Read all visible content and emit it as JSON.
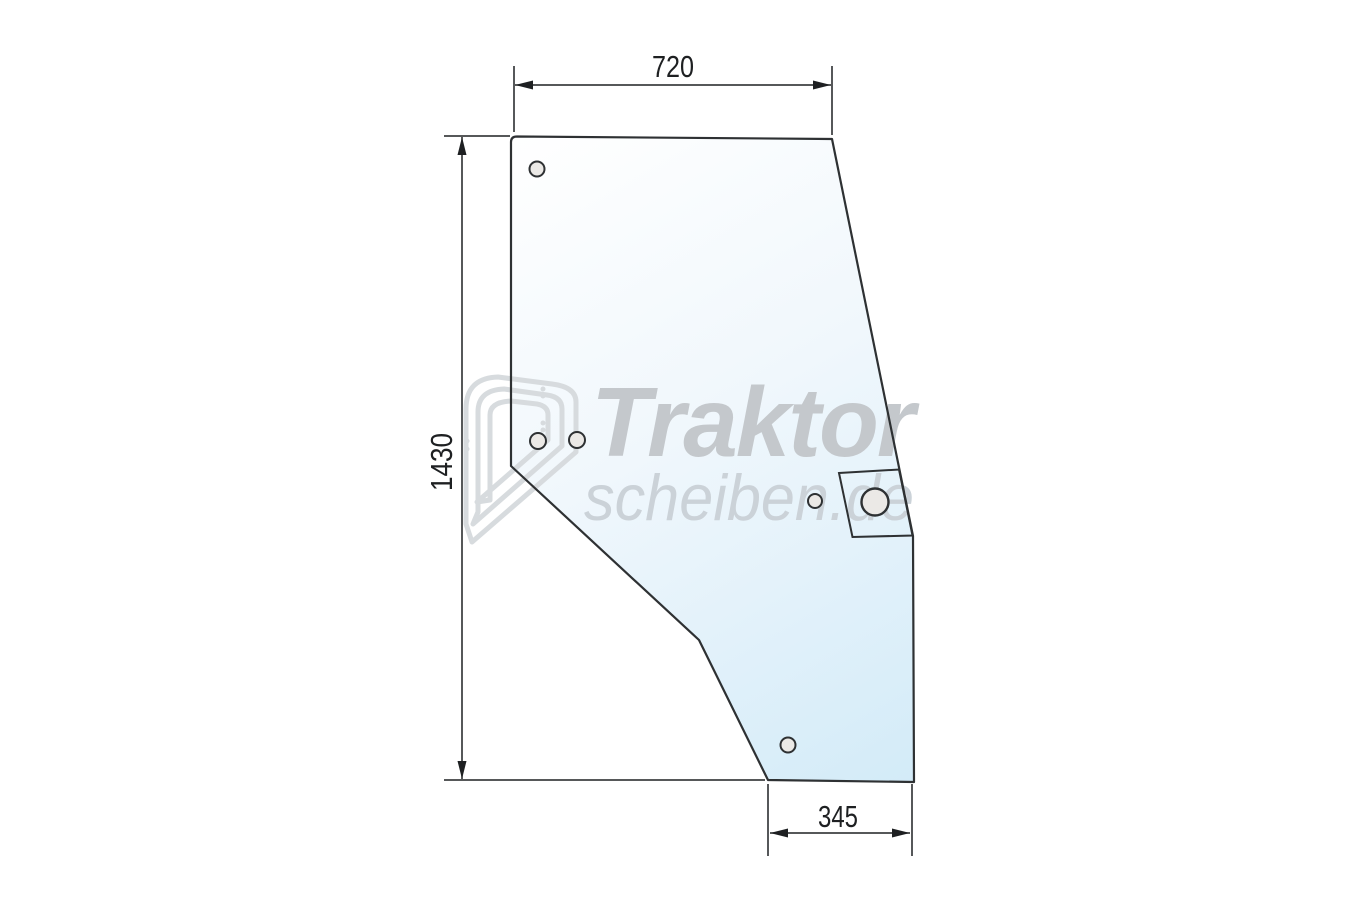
{
  "canvas": {
    "width": 1350,
    "height": 900,
    "background": "#ffffff"
  },
  "drawing": {
    "type": "technical-drawing",
    "subject": "tractor door glass panel outline with mounting holes",
    "dimensions": {
      "top_width": {
        "label": "720",
        "orientation": "horizontal"
      },
      "left_height": {
        "label": "1430",
        "orientation": "vertical"
      },
      "bottom_width": {
        "label": "345",
        "orientation": "horizontal"
      }
    },
    "holes": [
      {
        "x": 537,
        "y": 169,
        "r": 7.5
      },
      {
        "x": 538,
        "y": 441,
        "r": 8
      },
      {
        "x": 577,
        "y": 440,
        "r": 8
      },
      {
        "x": 815,
        "y": 501,
        "r": 7
      },
      {
        "x": 875,
        "y": 502,
        "r": 13.5
      },
      {
        "x": 788,
        "y": 745,
        "r": 7.5
      }
    ],
    "colors": {
      "glass_light": "#ffffff",
      "glass_mid": "#f0f7fc",
      "glass_blue": "#d3ebf8",
      "outline": "#2e3133",
      "dimension": "#1e2022",
      "hole_fill": "#ebe9e6",
      "watermark_title": "#c4c8cc",
      "watermark_subtitle": "#cbd2d8",
      "watermark_icon": "#d7dbde"
    }
  },
  "watermark": {
    "line1": "Traktor",
    "line2": "scheiben.de"
  }
}
